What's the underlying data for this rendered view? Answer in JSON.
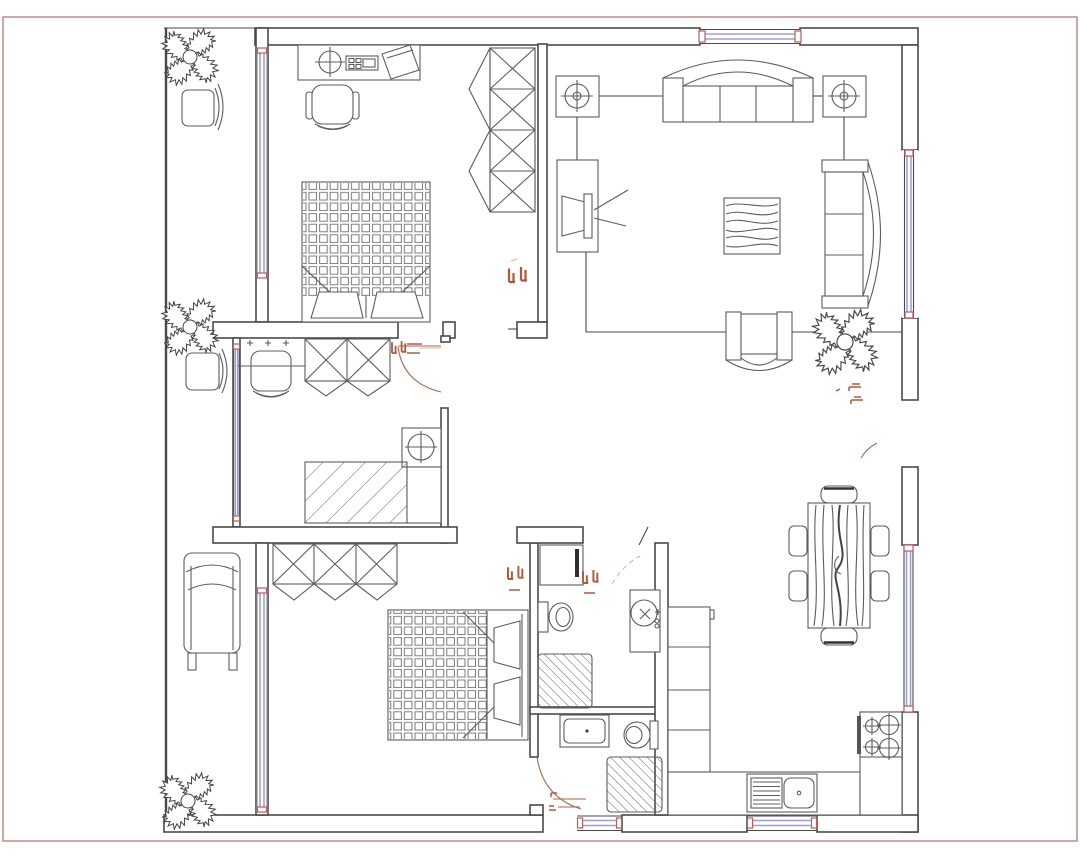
{
  "document": {
    "type": "architectural-floor-plan-cad-drawing",
    "background": "#ffffff",
    "sheet_border_color": "#c08080"
  },
  "palette": {
    "paper": "#ffffff",
    "wall_line": "#4a4a4a",
    "furniture_line": "#5c5c5c",
    "window_glass_line": "#9e9edd",
    "window_end_cap": "#c4575c",
    "door_swing": "#a5674e",
    "annotation_tag": "#b05a3c",
    "hatch_line": "#666666"
  },
  "rooms": [
    {
      "id": "bedroom-upper-left",
      "label": "Bedroom with double bed, desk, office chair and sliding wardrobe"
    },
    {
      "id": "living-room",
      "label": "Living room with three-seat sofa, two lamp end tables, curved sofa, armchair, TV cabinet and coffee table"
    },
    {
      "id": "dressing-room",
      "label": "Dressing room with wardrobe, vanity chair, washing machine and hatched counter"
    },
    {
      "id": "bedroom-lower-left",
      "label": "Bedroom with double bed and wardrobe"
    },
    {
      "id": "bathroom",
      "label": "Bathroom with two toilets, round basin, vanity sink and two hatched shower pans"
    },
    {
      "id": "kitchen-dining",
      "label": "Kitchen and dining area with six-chair wood table, tall cabinet, sink counter and four-burner stove"
    },
    {
      "id": "side-balcony",
      "label": "Left balcony strip with potted plants, two chairs and a lounge chair"
    }
  ],
  "furniture": [
    "desk with lamp, keyboard and monitor",
    "office chair",
    "double bed 1 (waffle mattress, two pillows)",
    "sliding wardrobe (4 X-panels)",
    "three-seat arched sofa",
    "end table with lamp (x2)",
    "TV cabinet with television",
    "wood-grain coffee table",
    "curved two-arc sofa",
    "U-shaped armchair",
    "potted plant (x4)",
    "dressing chair with plus marks",
    "wardrobe (2 X-panels)",
    "washing machine",
    "hatched counter",
    "double bed 2 (waffle mattress, two pillows)",
    "wardrobe (3 X-panels)",
    "lounge chair side view",
    "toilet (x2)",
    "round wash basin",
    "vanity sink cabinet",
    "shower pan hatched (x2)",
    "bathroom shelf with mirror bar",
    "dining table with wood grain and end benches",
    "dining chair (x4)",
    "tall kitchen cabinet column",
    "kitchen counter",
    "kitchen sink with drainboard",
    "four-burner gas stove"
  ],
  "openings": {
    "window_count": 8,
    "door_swing_count": 4,
    "red_tag_mark_count": 6
  }
}
